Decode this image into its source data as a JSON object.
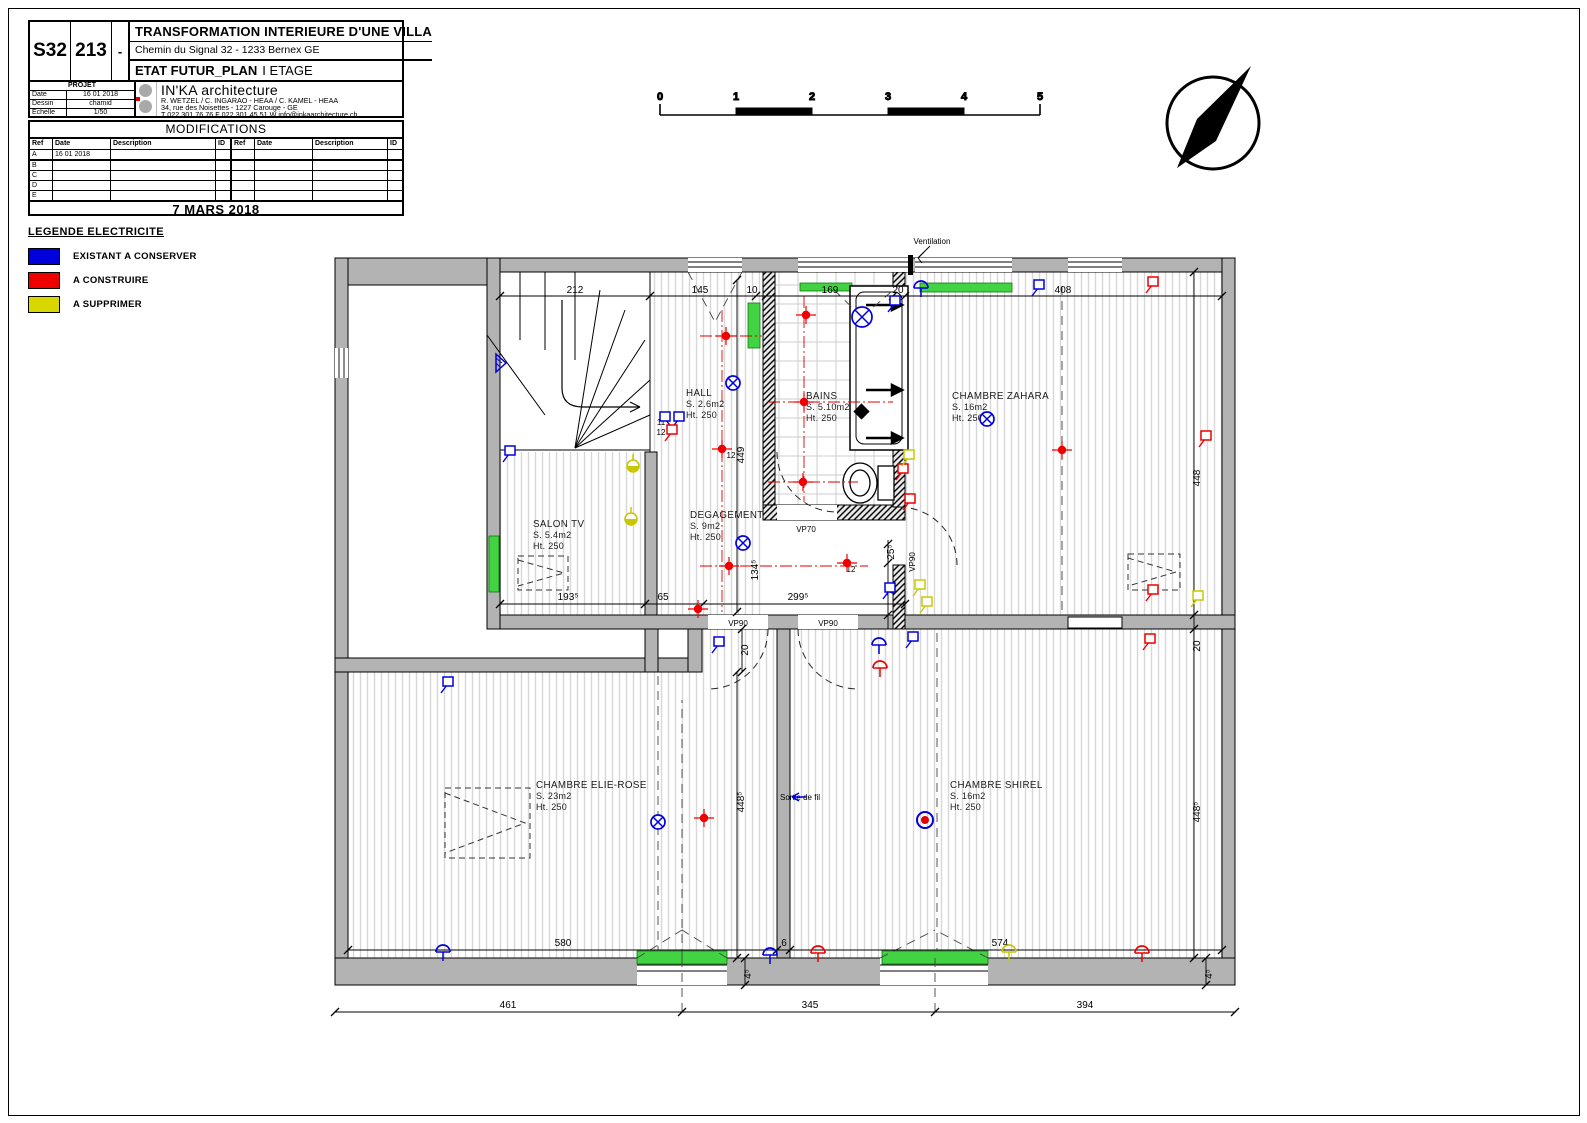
{
  "sheet": {
    "code1": "S32",
    "code2": "213",
    "code3": "-",
    "project_title": "TRANSFORMATION INTERIEURE D'UNE VILLA",
    "address": "Chemin du Signal 32 - 1233 Bernex GE",
    "plan_title": "ETAT FUTUR_PLAN",
    "plan_subtitle": "I ETAGE",
    "projet_label": "PROJET",
    "fields": [
      {
        "label": "Date",
        "value": "16 01 2018"
      },
      {
        "label": "Dessin",
        "value": "chamid"
      },
      {
        "label": "Echelle",
        "value": "1/50"
      }
    ],
    "firm": {
      "name": "IN'KA architecture",
      "line1": "R. WETZEL / C. INGARAO - HEAA / C. KAMEL - HEAA",
      "line2": "34, rue des Noisettes - 1227  Carouge - GE",
      "line3": "T 022 301 76 76 F 022 301 45 51 W info@inkaarchitecture.ch"
    }
  },
  "modifications": {
    "title": "MODIFICATIONS",
    "columns": [
      "Ref",
      "Date",
      "Description",
      "ID",
      "Ref",
      "Date",
      "Description",
      "ID"
    ],
    "rows": [
      {
        "ref": "A",
        "date": "16 01 2018",
        "desc": ""
      },
      {
        "ref": "B",
        "date": "",
        "desc": ""
      },
      {
        "ref": "C",
        "date": "",
        "desc": ""
      },
      {
        "ref": "D",
        "date": "",
        "desc": ""
      },
      {
        "ref": "E",
        "date": "",
        "desc": ""
      }
    ],
    "date_footer": "7 MARS 2018"
  },
  "legend": {
    "title": "LEGENDE ELECTRICITE",
    "items": [
      {
        "label": "EXISTANT A CONSERVER",
        "color": "#0000dd"
      },
      {
        "label": "A CONSTRUIRE",
        "color": "#ee0000"
      },
      {
        "label": "A SUPPRIMER",
        "color": "#d8d800"
      }
    ]
  },
  "scalebar": {
    "ticks": [
      "0",
      "1",
      "2",
      "3",
      "4",
      "5"
    ]
  },
  "plan": {
    "rooms": [
      {
        "name": "HALL",
        "area": "S. 2.6m2",
        "height": "Ht. 250",
        "x": 686,
        "y": 396
      },
      {
        "name": "BAINS",
        "area": "S. 5.10m2",
        "height": "Ht. 250",
        "x": 806,
        "y": 399
      },
      {
        "name": "CHAMBRE ZAHARA",
        "area": "S. 16m2",
        "height": "Ht. 250",
        "x": 952,
        "y": 399
      },
      {
        "name": "SALON TV",
        "area": "S. 5.4m2",
        "height": "Ht. 250",
        "x": 533,
        "y": 527
      },
      {
        "name": "DEGAGEMENT",
        "area": "S. 9m2",
        "height": "Ht. 250",
        "x": 690,
        "y": 518
      },
      {
        "name": "CHAMBRE ELIE-ROSE",
        "area": "S. 23m2",
        "height": "Ht. 250",
        "x": 536,
        "y": 788
      },
      {
        "name": "CHAMBRE SHIREL",
        "area": "S. 16m2",
        "height": "Ht. 250",
        "x": 950,
        "y": 788
      }
    ],
    "dims": [
      {
        "t": "212",
        "x": 575,
        "y": 293
      },
      {
        "t": "145",
        "x": 700,
        "y": 293
      },
      {
        "t": "10",
        "x": 752,
        "y": 293
      },
      {
        "t": "169",
        "x": 830,
        "y": 293
      },
      {
        "t": "20",
        "x": 898,
        "y": 293
      },
      {
        "t": "408",
        "x": 1063,
        "y": 293
      },
      {
        "t": "193⁵",
        "x": 568,
        "y": 600
      },
      {
        "t": "65",
        "x": 663,
        "y": 600
      },
      {
        "t": "299⁵",
        "x": 798,
        "y": 600
      },
      {
        "t": "580",
        "x": 563,
        "y": 946
      },
      {
        "t": "6",
        "x": 784,
        "y": 946
      },
      {
        "t": "574",
        "x": 1000,
        "y": 946
      },
      {
        "t": "461",
        "x": 508,
        "y": 1008
      },
      {
        "t": "345",
        "x": 810,
        "y": 1008
      },
      {
        "t": "394",
        "x": 1085,
        "y": 1008
      },
      {
        "t": "449",
        "x": 744,
        "y": 455,
        "r": -90
      },
      {
        "t": "134⁵",
        "x": 758,
        "y": 570,
        "r": -90
      },
      {
        "t": "448",
        "x": 1200,
        "y": 478,
        "r": -90
      },
      {
        "t": "20",
        "x": 1200,
        "y": 646,
        "r": -90
      },
      {
        "t": "25⁵",
        "x": 894,
        "y": 552,
        "r": -90
      },
      {
        "t": "70",
        "x": 894,
        "y": 590,
        "r": -90
      },
      {
        "t": "20",
        "x": 748,
        "y": 650,
        "r": -90
      },
      {
        "t": "448⁵",
        "x": 744,
        "y": 802,
        "r": -90
      },
      {
        "t": "448⁵",
        "x": 1200,
        "y": 812,
        "r": -90
      },
      {
        "t": "4⁵",
        "x": 751,
        "y": 974,
        "r": -90
      },
      {
        "t": "4⁵",
        "x": 1212,
        "y": 974,
        "r": -90
      }
    ],
    "annotations": [
      {
        "text": "Ventilation",
        "x": 932,
        "y": 244
      },
      {
        "text": "VP90",
        "x": 738,
        "y": 626
      },
      {
        "text": "VP90",
        "x": 828,
        "y": 626
      },
      {
        "text": "VP90",
        "x": 915,
        "y": 562,
        "r": -90
      },
      {
        "text": "VP70",
        "x": 806,
        "y": 532
      },
      {
        "text": "Sortie de fil",
        "x": 800,
        "y": 800,
        "c": "#0000dd"
      }
    ],
    "small_labels": [
      {
        "text": "11",
        "x": 661,
        "y": 425,
        "c": "#0000dd"
      },
      {
        "text": "12",
        "x": 661,
        "y": 435,
        "c": "#0000dd"
      },
      {
        "text": "12",
        "x": 731,
        "y": 458,
        "c": "#ee0000"
      },
      {
        "text": "12",
        "x": 851,
        "y": 572,
        "c": "#ee0000"
      }
    ],
    "symbols": [
      {
        "t": "lamp",
        "c": "#0000dd",
        "x": 733,
        "y": 383
      },
      {
        "t": "lamp",
        "c": "#0000dd",
        "x": 862,
        "y": 317,
        "r": 10
      },
      {
        "t": "switch",
        "c": "#0000dd",
        "x": 888,
        "y": 312
      },
      {
        "t": "socket",
        "c": "#0000dd",
        "x": 921,
        "y": 288
      },
      {
        "t": "switch",
        "c": "#0000dd",
        "x": 1032,
        "y": 296
      },
      {
        "t": "switch",
        "c": "#0000dd",
        "x": 503,
        "y": 462
      },
      {
        "t": "switch2",
        "c": "#0000dd",
        "x": 672,
        "y": 428
      },
      {
        "t": "switch",
        "c": "#ee0000",
        "x": 665,
        "y": 441
      },
      {
        "t": "lamp",
        "c": "#0000dd",
        "x": 743,
        "y": 543
      },
      {
        "t": "lamp",
        "c": "#0000dd",
        "x": 987,
        "y": 419
      },
      {
        "t": "switch",
        "c": "#0000dd",
        "x": 883,
        "y": 599
      },
      {
        "t": "socket",
        "c": "#0000dd",
        "x": 879,
        "y": 645
      },
      {
        "t": "switch",
        "c": "#0000dd",
        "x": 906,
        "y": 648
      },
      {
        "t": "switch",
        "c": "#0000dd",
        "x": 712,
        "y": 653
      },
      {
        "t": "lamp",
        "c": "#0000dd",
        "x": 658,
        "y": 822
      },
      {
        "t": "switch",
        "c": "#0000dd",
        "x": 441,
        "y": 693
      },
      {
        "t": "socket",
        "c": "#0000dd",
        "x": 443,
        "y": 952
      },
      {
        "t": "socket",
        "c": "#0000dd",
        "x": 770,
        "y": 955
      },
      {
        "t": "ring",
        "c": "#0000dd",
        "x": 925,
        "y": 820
      },
      {
        "t": "tri",
        "c": "#0000dd",
        "x": 496,
        "y": 363
      },
      {
        "t": "spot",
        "c": "#ee0000",
        "x": 726,
        "y": 336
      },
      {
        "t": "spot",
        "c": "#ee0000",
        "x": 806,
        "y": 315
      },
      {
        "t": "spot",
        "c": "#ee0000",
        "x": 804,
        "y": 402
      },
      {
        "t": "spot",
        "c": "#ee0000",
        "x": 803,
        "y": 482
      },
      {
        "t": "spot",
        "c": "#ee0000",
        "x": 722,
        "y": 449
      },
      {
        "t": "spot",
        "c": "#ee0000",
        "x": 729,
        "y": 566
      },
      {
        "t": "spot",
        "c": "#ee0000",
        "x": 847,
        "y": 563
      },
      {
        "t": "spot",
        "c": "#ee0000",
        "x": 698,
        "y": 609
      },
      {
        "t": "spot",
        "c": "#ee0000",
        "x": 1062,
        "y": 450
      },
      {
        "t": "spot",
        "c": "#ee0000",
        "x": 704,
        "y": 818
      },
      {
        "t": "switch",
        "c": "#ee0000",
        "x": 1146,
        "y": 293
      },
      {
        "t": "switch",
        "c": "#ee0000",
        "x": 1199,
        "y": 447
      },
      {
        "t": "switch",
        "c": "#ee0000",
        "x": 1146,
        "y": 601
      },
      {
        "t": "switch",
        "c": "#ee0000",
        "x": 1143,
        "y": 650
      },
      {
        "t": "socket",
        "c": "#ee0000",
        "x": 818,
        "y": 953
      },
      {
        "t": "socket",
        "c": "#ee0000",
        "x": 1142,
        "y": 953
      },
      {
        "t": "switch",
        "c": "#ee0000",
        "x": 896,
        "y": 480
      },
      {
        "t": "switch",
        "c": "#ee0000",
        "x": 903,
        "y": 510
      },
      {
        "t": "socket",
        "c": "#ee0000",
        "x": 880,
        "y": 668
      },
      {
        "t": "ylamp",
        "c": "#c8c800",
        "x": 633,
        "y": 466
      },
      {
        "t": "ylamp",
        "c": "#c8c800",
        "x": 631,
        "y": 519
      },
      {
        "t": "switch",
        "c": "#c8c800",
        "x": 913,
        "y": 596
      },
      {
        "t": "switch",
        "c": "#c8c800",
        "x": 920,
        "y": 613
      },
      {
        "t": "socket",
        "c": "#c8c800",
        "x": 1009,
        "y": 952
      },
      {
        "t": "switch",
        "c": "#c8c800",
        "x": 1191,
        "y": 607
      },
      {
        "t": "switch",
        "c": "#c8c800",
        "x": 902,
        "y": 466
      },
      {
        "t": "arrowL",
        "c": "#0000dd",
        "x": 792,
        "y": 797
      }
    ]
  }
}
